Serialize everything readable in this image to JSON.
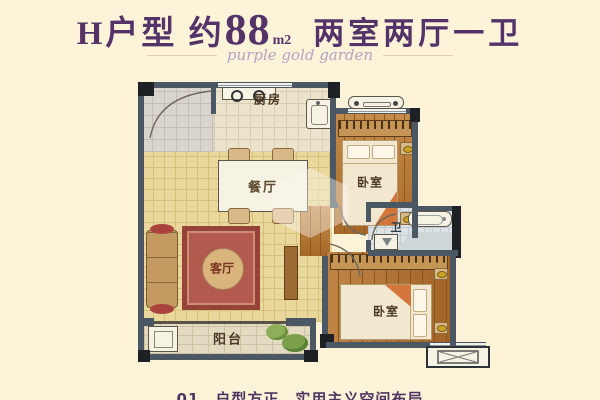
{
  "header": {
    "title_left": "H户型 约",
    "title_num": "88",
    "title_unit": "m2",
    "title_right": "两室两厅一卫",
    "subtitle": "purple gold garden"
  },
  "rooms": {
    "kitchen": {
      "label": "厨房"
    },
    "dining": {
      "label": "餐厅"
    },
    "living": {
      "label": "客厅"
    },
    "bedroom_top": {
      "label": "卧室"
    },
    "bedroom_bottom": {
      "label": "卧室"
    },
    "bath": {
      "label": "卫"
    },
    "balcony": {
      "label": "阳台"
    }
  },
  "footnote": "01、户型方正，实用主义空间布局",
  "colors": {
    "background": "#fdf3d9",
    "title_purple": "#543368",
    "subtitle_lavender": "#b4a3c2",
    "wall_slate": "#4b5762",
    "wall_black": "#1d2125",
    "tile_yellow": "#e9d79c",
    "wood_brown": "#b1722f",
    "carpet_red": "#b25a4d",
    "plant_green": "#6f9a47"
  },
  "icons": [
    "stove-icon",
    "kitchen-sink-icon",
    "dining-table-icon",
    "chair-icon",
    "sofa-icon",
    "rug-icon",
    "tv-cabinet-icon",
    "bed-icon",
    "nightstand-icon",
    "wardrobe-icon",
    "bathtub-icon",
    "washbasin-icon",
    "shower-icon",
    "washing-machine-icon",
    "plant-icon",
    "ac-unit-icon",
    "door-arc-icon",
    "window-icon",
    "watermark-house-icon"
  ]
}
